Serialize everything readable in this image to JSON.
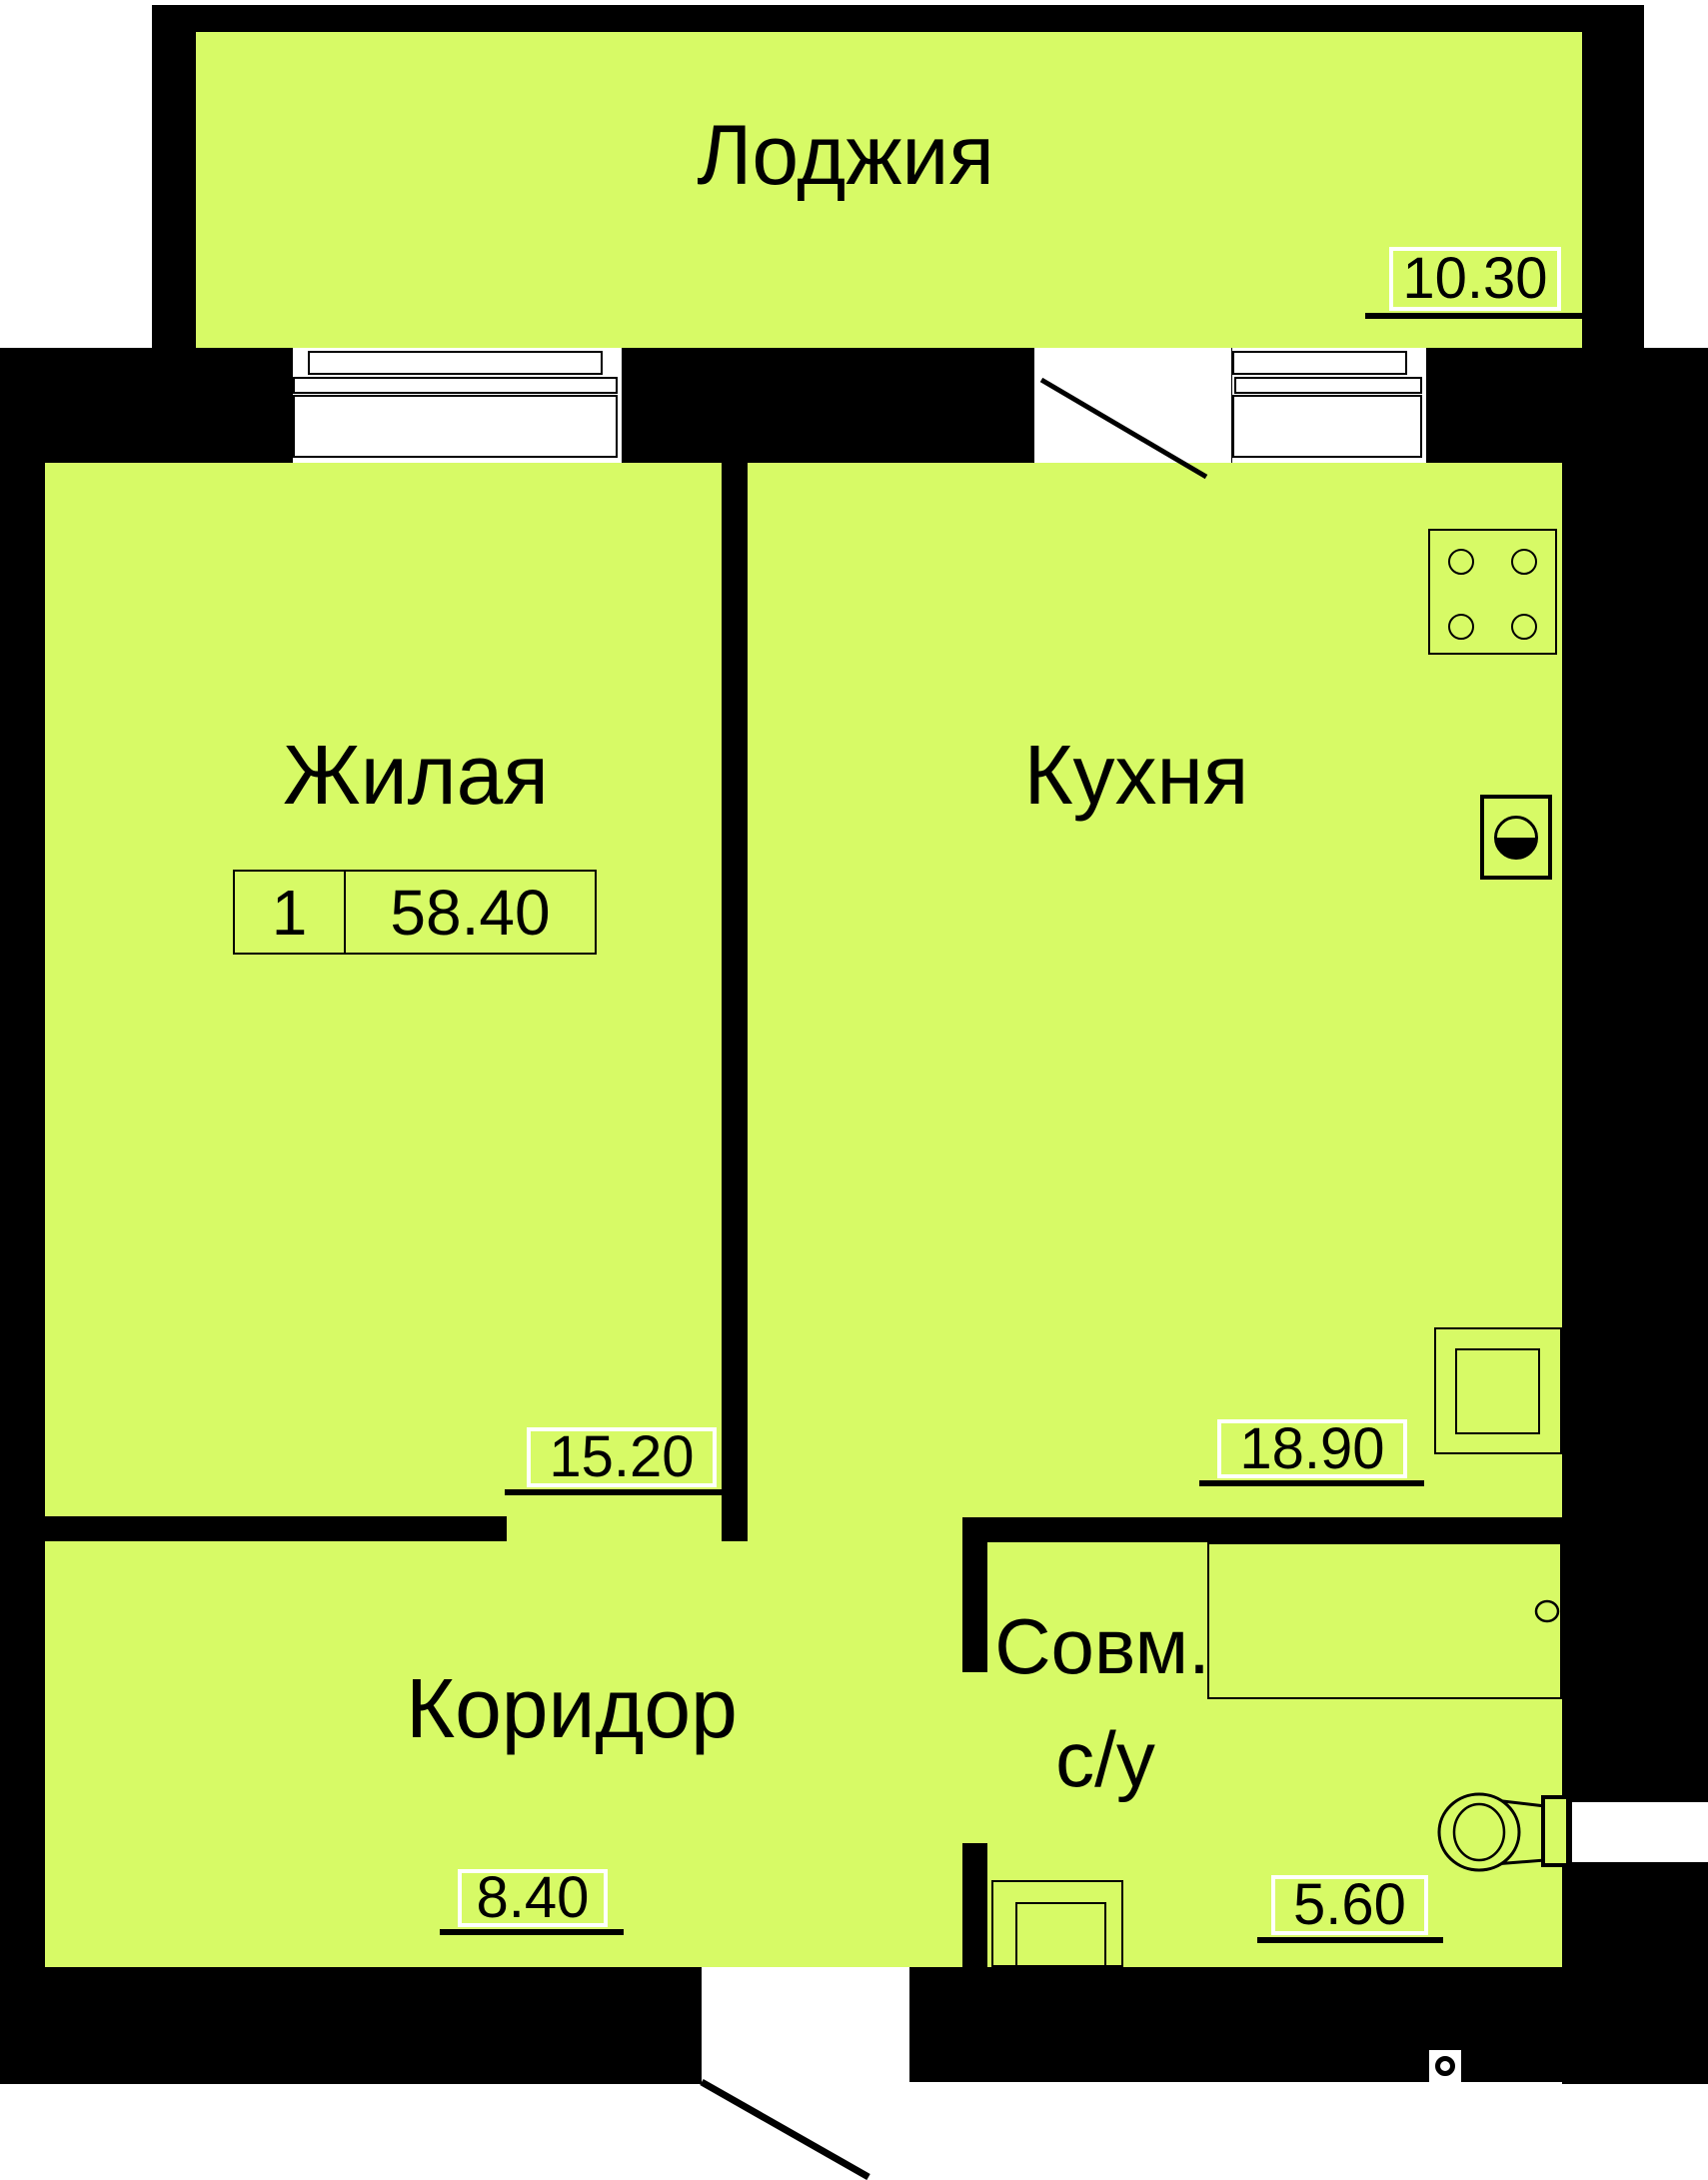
{
  "plan": {
    "title": "apartment-floor-plan",
    "unit_badge": {
      "rooms": "1",
      "total_area": "58.40"
    },
    "rooms": [
      {
        "id": "loggia",
        "name": "Лоджия",
        "area": "10.30"
      },
      {
        "id": "living",
        "name": "Жилая",
        "area": "15.20"
      },
      {
        "id": "kitchen",
        "name": "Кухня",
        "area": "18.90"
      },
      {
        "id": "corridor",
        "name": "Коридор",
        "area": "8.40"
      },
      {
        "id": "bathroom",
        "name_line1": "Совм.",
        "name_line2": "с/у",
        "area": "5.60"
      }
    ],
    "fixtures": [
      "stove",
      "washing-machine",
      "kitchen-sink",
      "bathtub",
      "toilet",
      "bathroom-sink",
      "peephole"
    ],
    "colors": {
      "floor": "#d7fa66",
      "wall": "#000000",
      "label_box": "#ffffff"
    }
  }
}
